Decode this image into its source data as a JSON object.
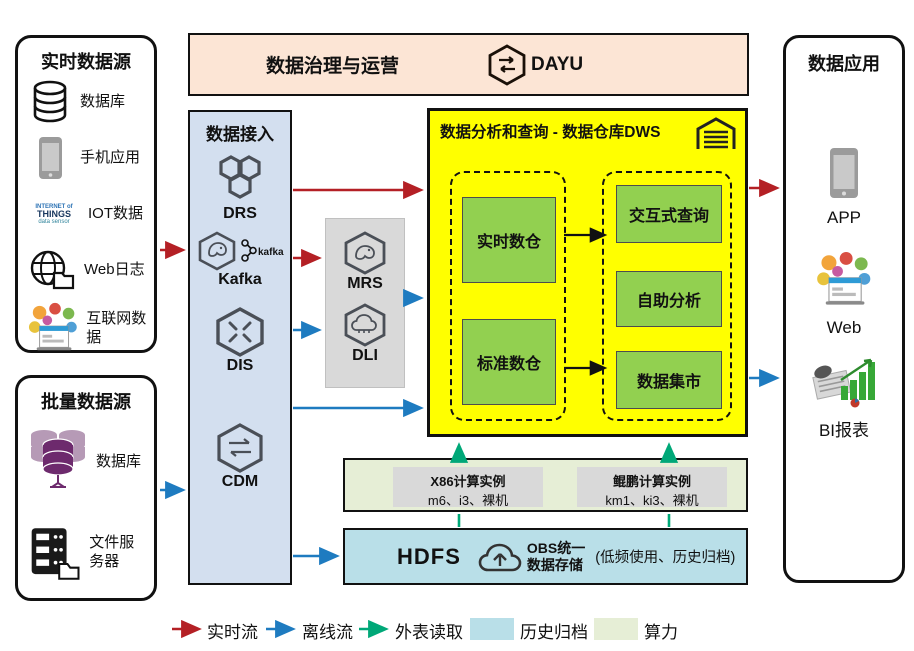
{
  "realtime_sources": {
    "title": "实时数据源",
    "items": [
      {
        "icon": "database-icon",
        "label": "数据库"
      },
      {
        "icon": "mobile-phone-icon",
        "label": "手机应用"
      },
      {
        "icon": "iot-cloud-icon",
        "label": "IOT数据"
      },
      {
        "icon": "globe-folder-icon",
        "label": "Web日志"
      },
      {
        "icon": "internet-bubbles-icon",
        "label": "互联网数据"
      }
    ],
    "iot_words": {
      "line1": "INTERNET of",
      "line2": "THINGS",
      "line3": "data sensor"
    }
  },
  "batch_sources": {
    "title": "批量数据源",
    "items": [
      {
        "icon": "database-purple-icon",
        "label": "数据库"
      },
      {
        "icon": "file-server-icon",
        "label": "文件服务器"
      }
    ]
  },
  "governance": {
    "title": "数据治理与运营",
    "product": "DAYU"
  },
  "data_access": {
    "title": "数据接入",
    "services": [
      {
        "icon": "drs-hexagon-icon",
        "label": "DRS"
      },
      {
        "icon": "kafka-hexagon-icon",
        "label": "Kafka",
        "badge": "kafka"
      },
      {
        "icon": "dis-hexagon-icon",
        "label": "DIS"
      },
      {
        "icon": "cdm-hexagon-icon",
        "label": "CDM"
      }
    ]
  },
  "processing": {
    "services": [
      {
        "icon": "mrs-hexagon-icon",
        "label": "MRS"
      },
      {
        "icon": "dli-hexagon-icon",
        "label": "DLI"
      }
    ]
  },
  "dws": {
    "title": "数据分析和查询 - 数据仓库DWS",
    "left_group": [
      "实时数仓",
      "标准数仓"
    ],
    "right_group": [
      "交互式查询",
      "自助分析",
      "数据集市"
    ]
  },
  "compute": {
    "instances": [
      {
        "name": "X86计算实例",
        "specs": "m6、i3、裸机"
      },
      {
        "name": "鲲鹏计算实例",
        "specs": "km1、ki3、裸机"
      }
    ]
  },
  "storage": {
    "hdfs": "HDFS",
    "obs_line1": "OBS统一",
    "obs_line2": "数据存储",
    "note": "(低频使用、历史归档)"
  },
  "data_apps": {
    "title": "数据应用",
    "items": [
      {
        "icon": "app-phone-icon",
        "label": "APP"
      },
      {
        "icon": "web-bubbles-icon",
        "label": "Web"
      },
      {
        "icon": "bi-chart-icon",
        "label": "BI报表"
      }
    ]
  },
  "legend": {
    "realtime": {
      "label": "实时流",
      "color": "#b42025"
    },
    "offline": {
      "label": "离线流",
      "color": "#1e7bc0"
    },
    "external": {
      "label": "外表读取",
      "color": "#00a878"
    },
    "archive": {
      "label": "历史归档",
      "color": "#b9dfe8"
    },
    "compute": {
      "label": "算力",
      "color": "#e6eed6"
    }
  }
}
